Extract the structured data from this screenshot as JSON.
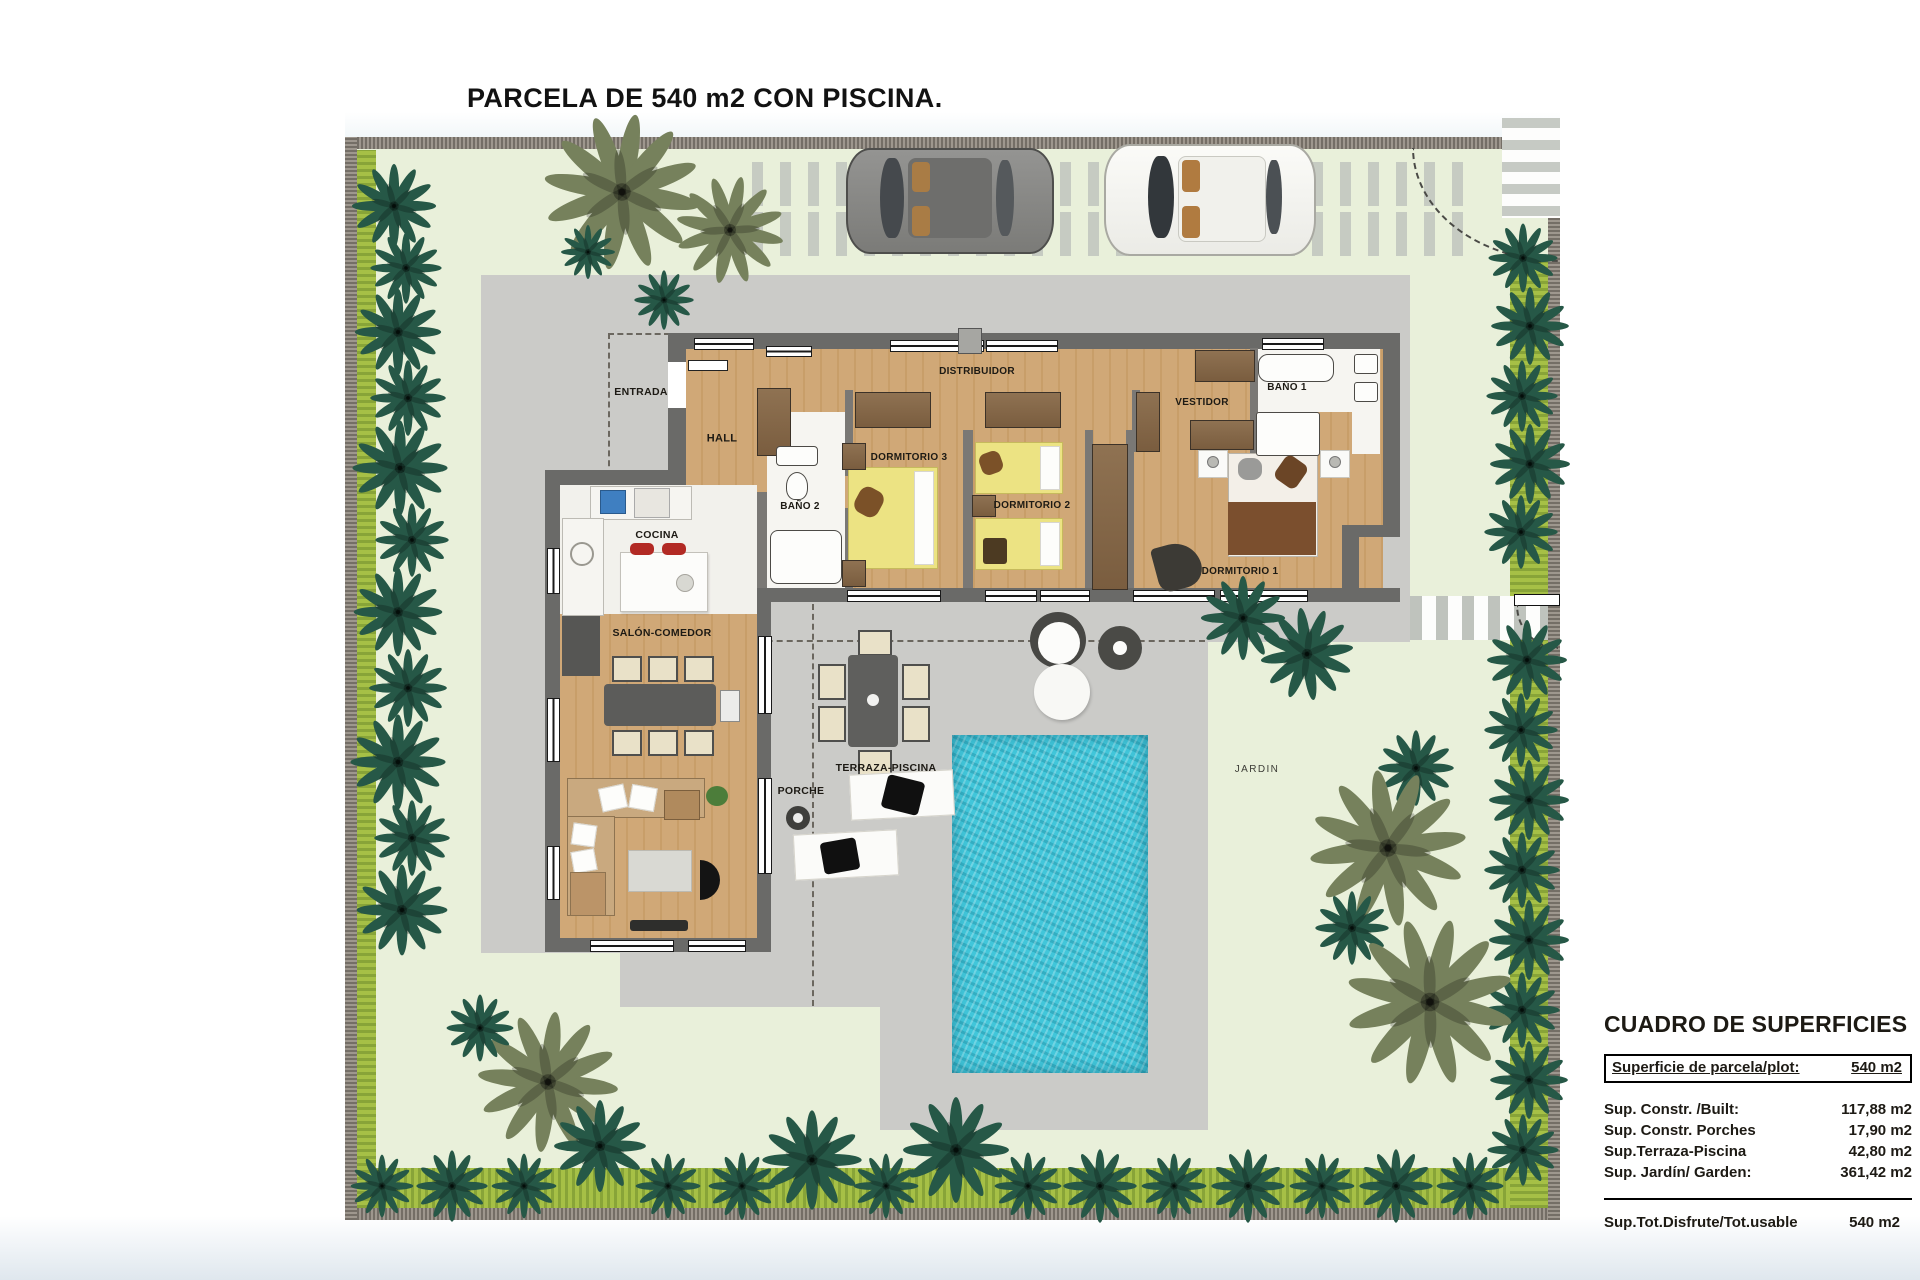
{
  "title": "PARCELA DE 540 m2 CON PISCINA.",
  "plan": {
    "rooms": {
      "entrada": "ENTRADA",
      "hall": "HALL",
      "distribuidor": "DISTRIBUIDOR",
      "dormitorio3": "DORMITORIO 3",
      "dormitorio2": "DORMITORIO 2",
      "dormitorio1": "DORMITORIO 1",
      "bano2": "BAÑO 2",
      "bano1": "BAÑO 1",
      "vestidor": "VESTIDOR",
      "cocina": "COCINA",
      "salon_comedor": "SALÓN-COMEDOR",
      "porche": "PORCHE",
      "terraza_piscina": "TERRAZA-PISCINA",
      "jardin": "JARDIN"
    }
  },
  "surfaces": {
    "heading": "CUADRO DE SUPERFICIES",
    "plot_row": {
      "label": "Superficie de parcela/plot:",
      "value": "540 m2"
    },
    "rows": [
      {
        "label": "Sup. Constr. /Built:",
        "value": "117,88 m2"
      },
      {
        "label": "Sup. Constr. Porches",
        "value": "17,90 m2"
      },
      {
        "label": "Sup.Terraza-Piscina",
        "value": "42,80 m2"
      },
      {
        "label": "Sup. Jardín/ Garden:",
        "value": "361,42 m2"
      }
    ],
    "total_row": {
      "label": "Sup.Tot.Disfrute/Tot.usable",
      "value": "540 m2"
    }
  },
  "colors": {
    "garden": "#e9f0da",
    "hedge": "#a6c046",
    "paving": "#cbcbc8",
    "pool": "#41c6da",
    "wood_floor": "#d0a877",
    "palm_dark": "#265847",
    "palm_olive": "#76815c"
  }
}
